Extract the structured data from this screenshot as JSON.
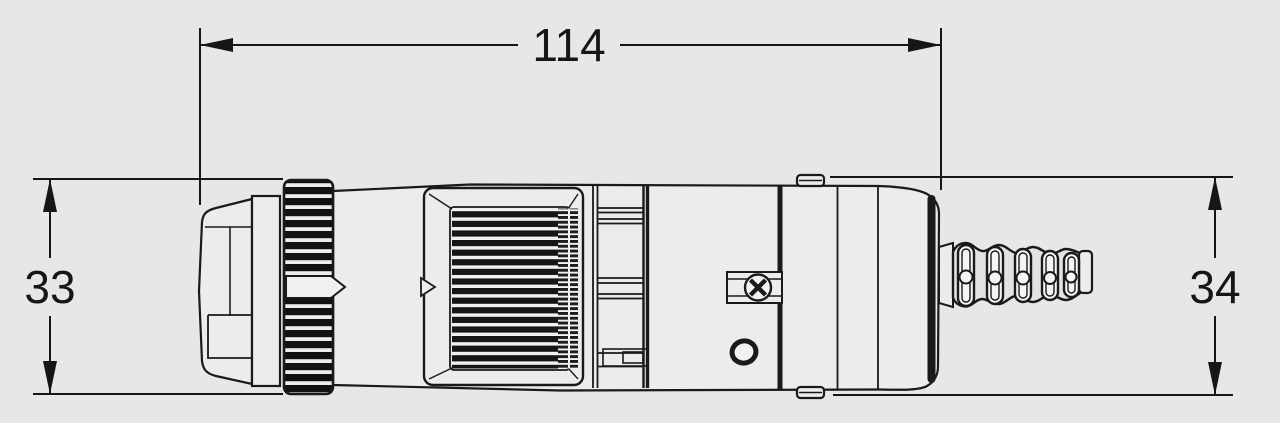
{
  "drawing": {
    "kind": "engineering-dimensioned-side-view",
    "colors": {
      "background": "#e7e7e7",
      "line": "#1a1a1a",
      "body_fill": "#ececec",
      "pad_dark": "#161616",
      "slot_fill": "#f4f4f4"
    },
    "dimensions": {
      "overall_length": {
        "label": "114"
      },
      "front_height": {
        "label": "33"
      },
      "rear_height": {
        "label": "34"
      }
    }
  }
}
